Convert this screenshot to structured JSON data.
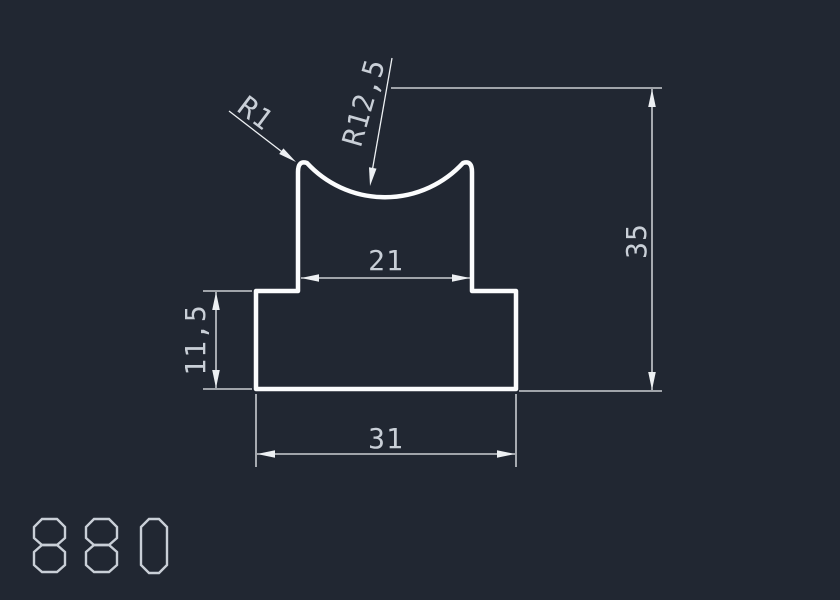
{
  "drawing": {
    "type": "cad-profile-cross-section",
    "background_color": "#212732",
    "line_color": "#edf0f3",
    "profile_color": "#fbfcfd",
    "text_color": "#c9cfd7",
    "part_number": "880",
    "dimensions": {
      "neck_width": {
        "label": "21"
      },
      "base_width": {
        "label": "31"
      },
      "base_height": {
        "label": "11,5"
      },
      "total_height": {
        "label": "35"
      },
      "corner_radius": {
        "label": "R1"
      },
      "groove_radius": {
        "label": "R12,5"
      }
    }
  }
}
